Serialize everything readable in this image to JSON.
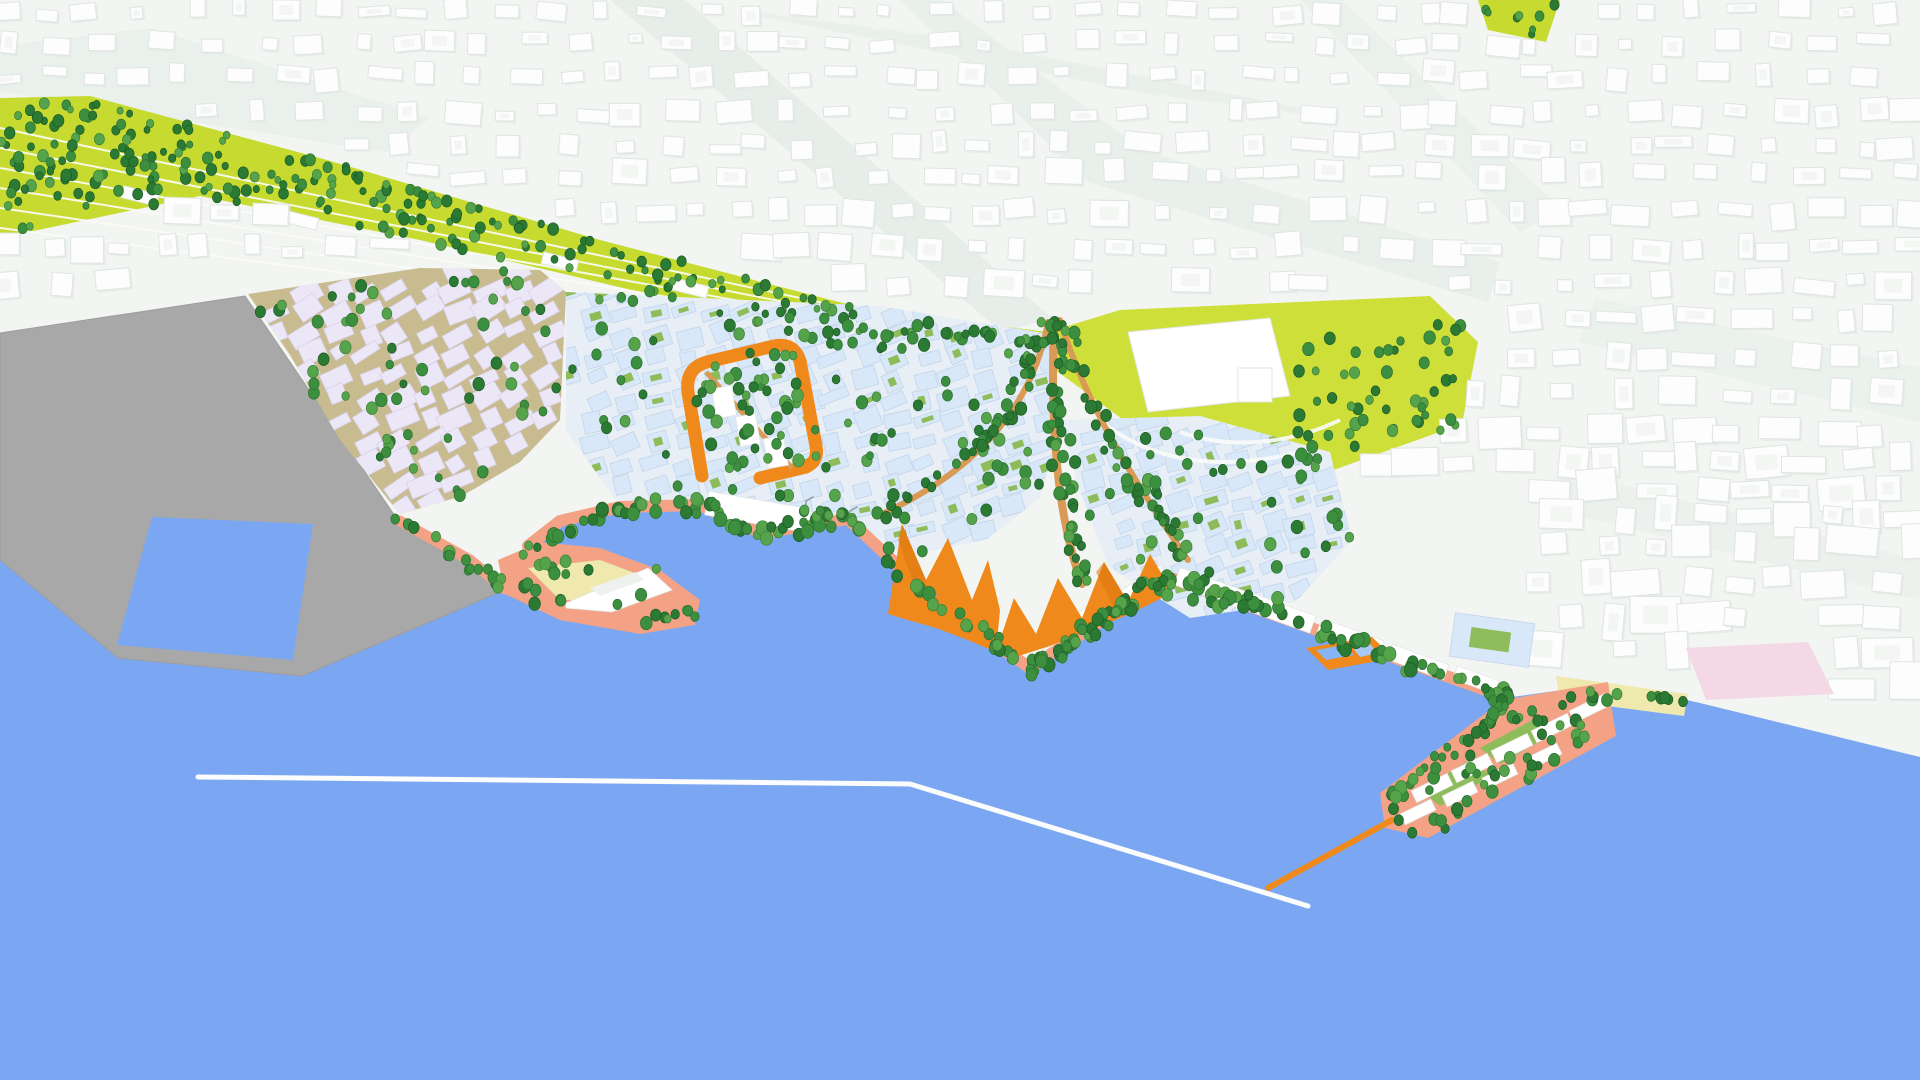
{
  "scene": {
    "title": "Aerial 3D rendering of a waterfront city masterplan model",
    "view": "isometric bird's-eye view, harbour in foreground, city fading to white in background",
    "features": {
      "water": "harbour basin and open water",
      "port_piers": "vacant flat grey port piers with water notch",
      "rail_corridor": "chartreuse railway park corridor densely lined with trees",
      "lavender_quarter": "low-rise lavender development quarter on tan street grid",
      "blue_quarter": "light-blue development quarter with green courtyards",
      "orange_courtyard_block": "orange perimeter block framing white gabled houses and trees",
      "orange_sawtooth_building": "orange zig-zag sawtooth building along the waterfront",
      "harbour_bath": "floating orange harbour bath with two blue pools",
      "orange_pier": "thin orange pier reaching into the basin",
      "breakwater": "long thin white breakwater with a bend",
      "event_hall": "large white hall on a chartreuse lawn",
      "rail_fan": "fan of tan park paths with tree rows curving through the plan",
      "v_building": "white arrow-shaped building on a small salmon point",
      "se_peninsula": "south-east peninsula with white slabs, trees and green patches",
      "beach": "pale sand beach",
      "pink_plaza": "pink plaza square",
      "promenade": "salmon waterfront promenade with continuous tree rows",
      "background_city": "existing city as white block massing with pale streets and rail-yard streaks"
    }
  },
  "palette": {
    "water": "#7BA7F2",
    "pool_light": "#A9C8F6",
    "pool_mid": "#86B4F4",
    "city_ground": "#F2F5F2",
    "street": "#E5ECE8",
    "rail_streak": "#E9EFEA",
    "building_white": "#FCFDFC",
    "building_shadow": "#E2E8E5",
    "gray_port": "#A8A8A8",
    "lavender_building": "#ECE7F6",
    "lavender_ground": "#C7BB8F",
    "blue_building": "#D9E8F8",
    "blue_ground": "#E7EEF5",
    "chartreuse": "#C6DA30",
    "lawn": "#CFDF3A",
    "courtyard_green": "#8FBC5A",
    "tree_dark": "#2B7A33",
    "tree_mid": "#3C8F3F",
    "tree_light": "#55A34A",
    "salmon": "#F3A286",
    "salmon_light": "#F8C0A6",
    "orange": "#F0891B",
    "orange_dark": "#D8770F",
    "beach": "#EFE9AE",
    "pink_plaza": "#F4D8E5",
    "breakwater": "#FBFCFD",
    "path_tan": "#D89A55",
    "hall_white": "#FFFFFF",
    "crane_gray": "#9AA1A6"
  }
}
